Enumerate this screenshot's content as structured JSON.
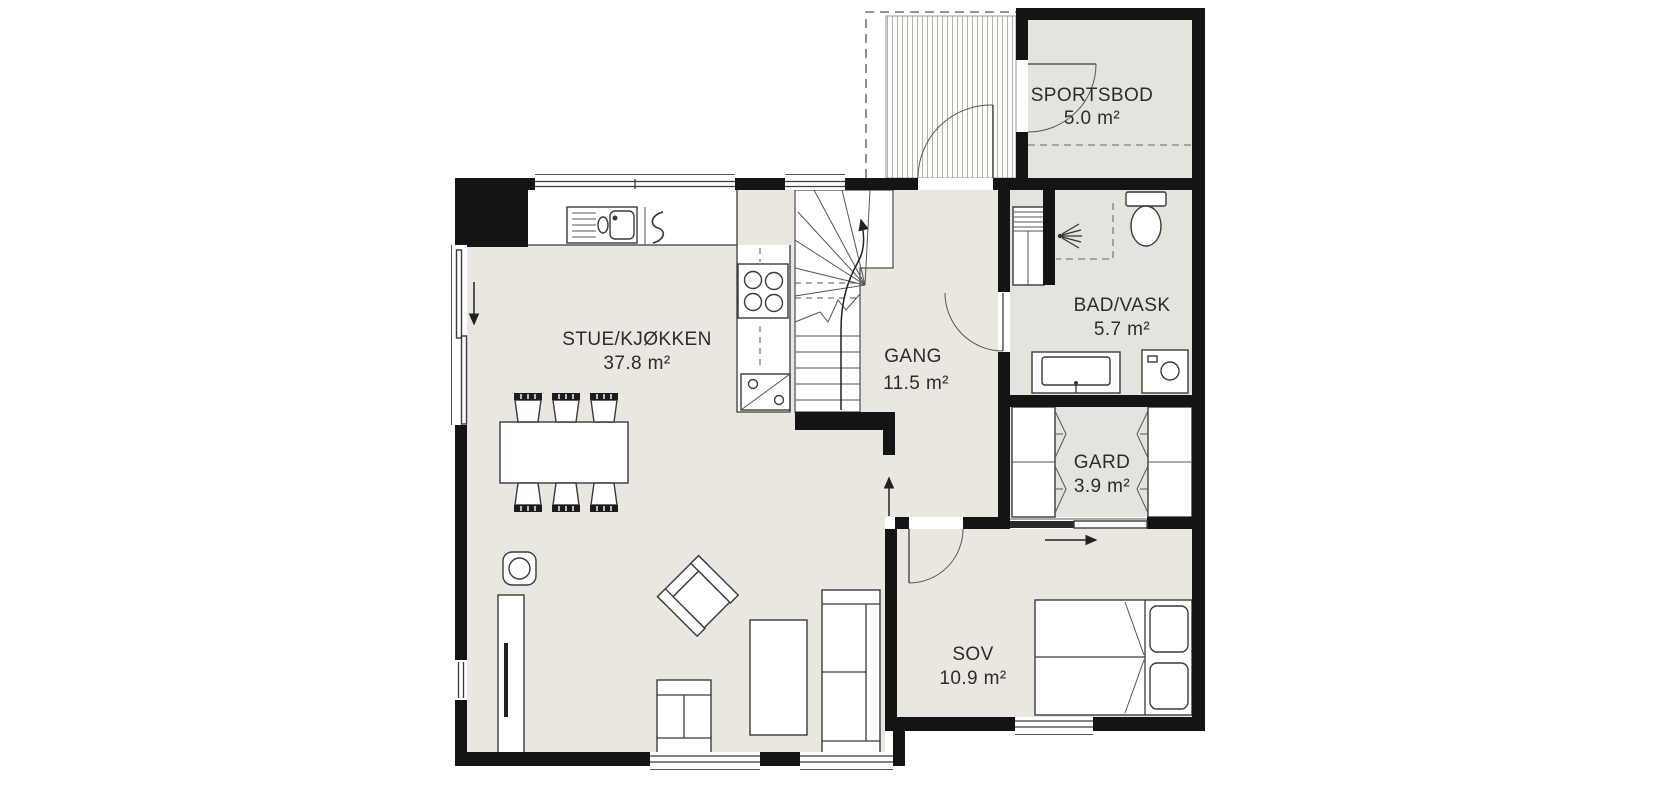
{
  "plan": {
    "rooms": [
      {
        "name": "SPORTSBOD",
        "area": "5.0 m²"
      },
      {
        "name": "STUE/KJØKKEN",
        "area": "37.8 m²"
      },
      {
        "name": "GANG",
        "area": "11.5 m²"
      },
      {
        "name": "BAD/VASK",
        "area": "5.7 m²"
      },
      {
        "name": "GARD",
        "area": "3.9 m²"
      },
      {
        "name": "SOV",
        "area": "10.9 m²"
      }
    ],
    "colors": {
      "wall": "#141414",
      "floor_main": "#e9e7df",
      "floor_wet": "#e4e3de",
      "background": "#ffffff",
      "hatch_line": "#b5b2ac"
    },
    "icons": {
      "kitchen_sink": "kitchen-sink-icon",
      "cooktop": "cooktop-4-burner-icon",
      "dishwasher": "dishwasher-icon",
      "shower": "shower-spray-icon",
      "toilet": "toilet-icon",
      "washing_machine": "washing-machine-icon",
      "vanity": "vanity-sink-icon",
      "wood_stove": "wood-stove-icon",
      "stairs": "stairs-up",
      "bed": "double-bed",
      "wardrobe": "wardrobe-fold"
    }
  }
}
